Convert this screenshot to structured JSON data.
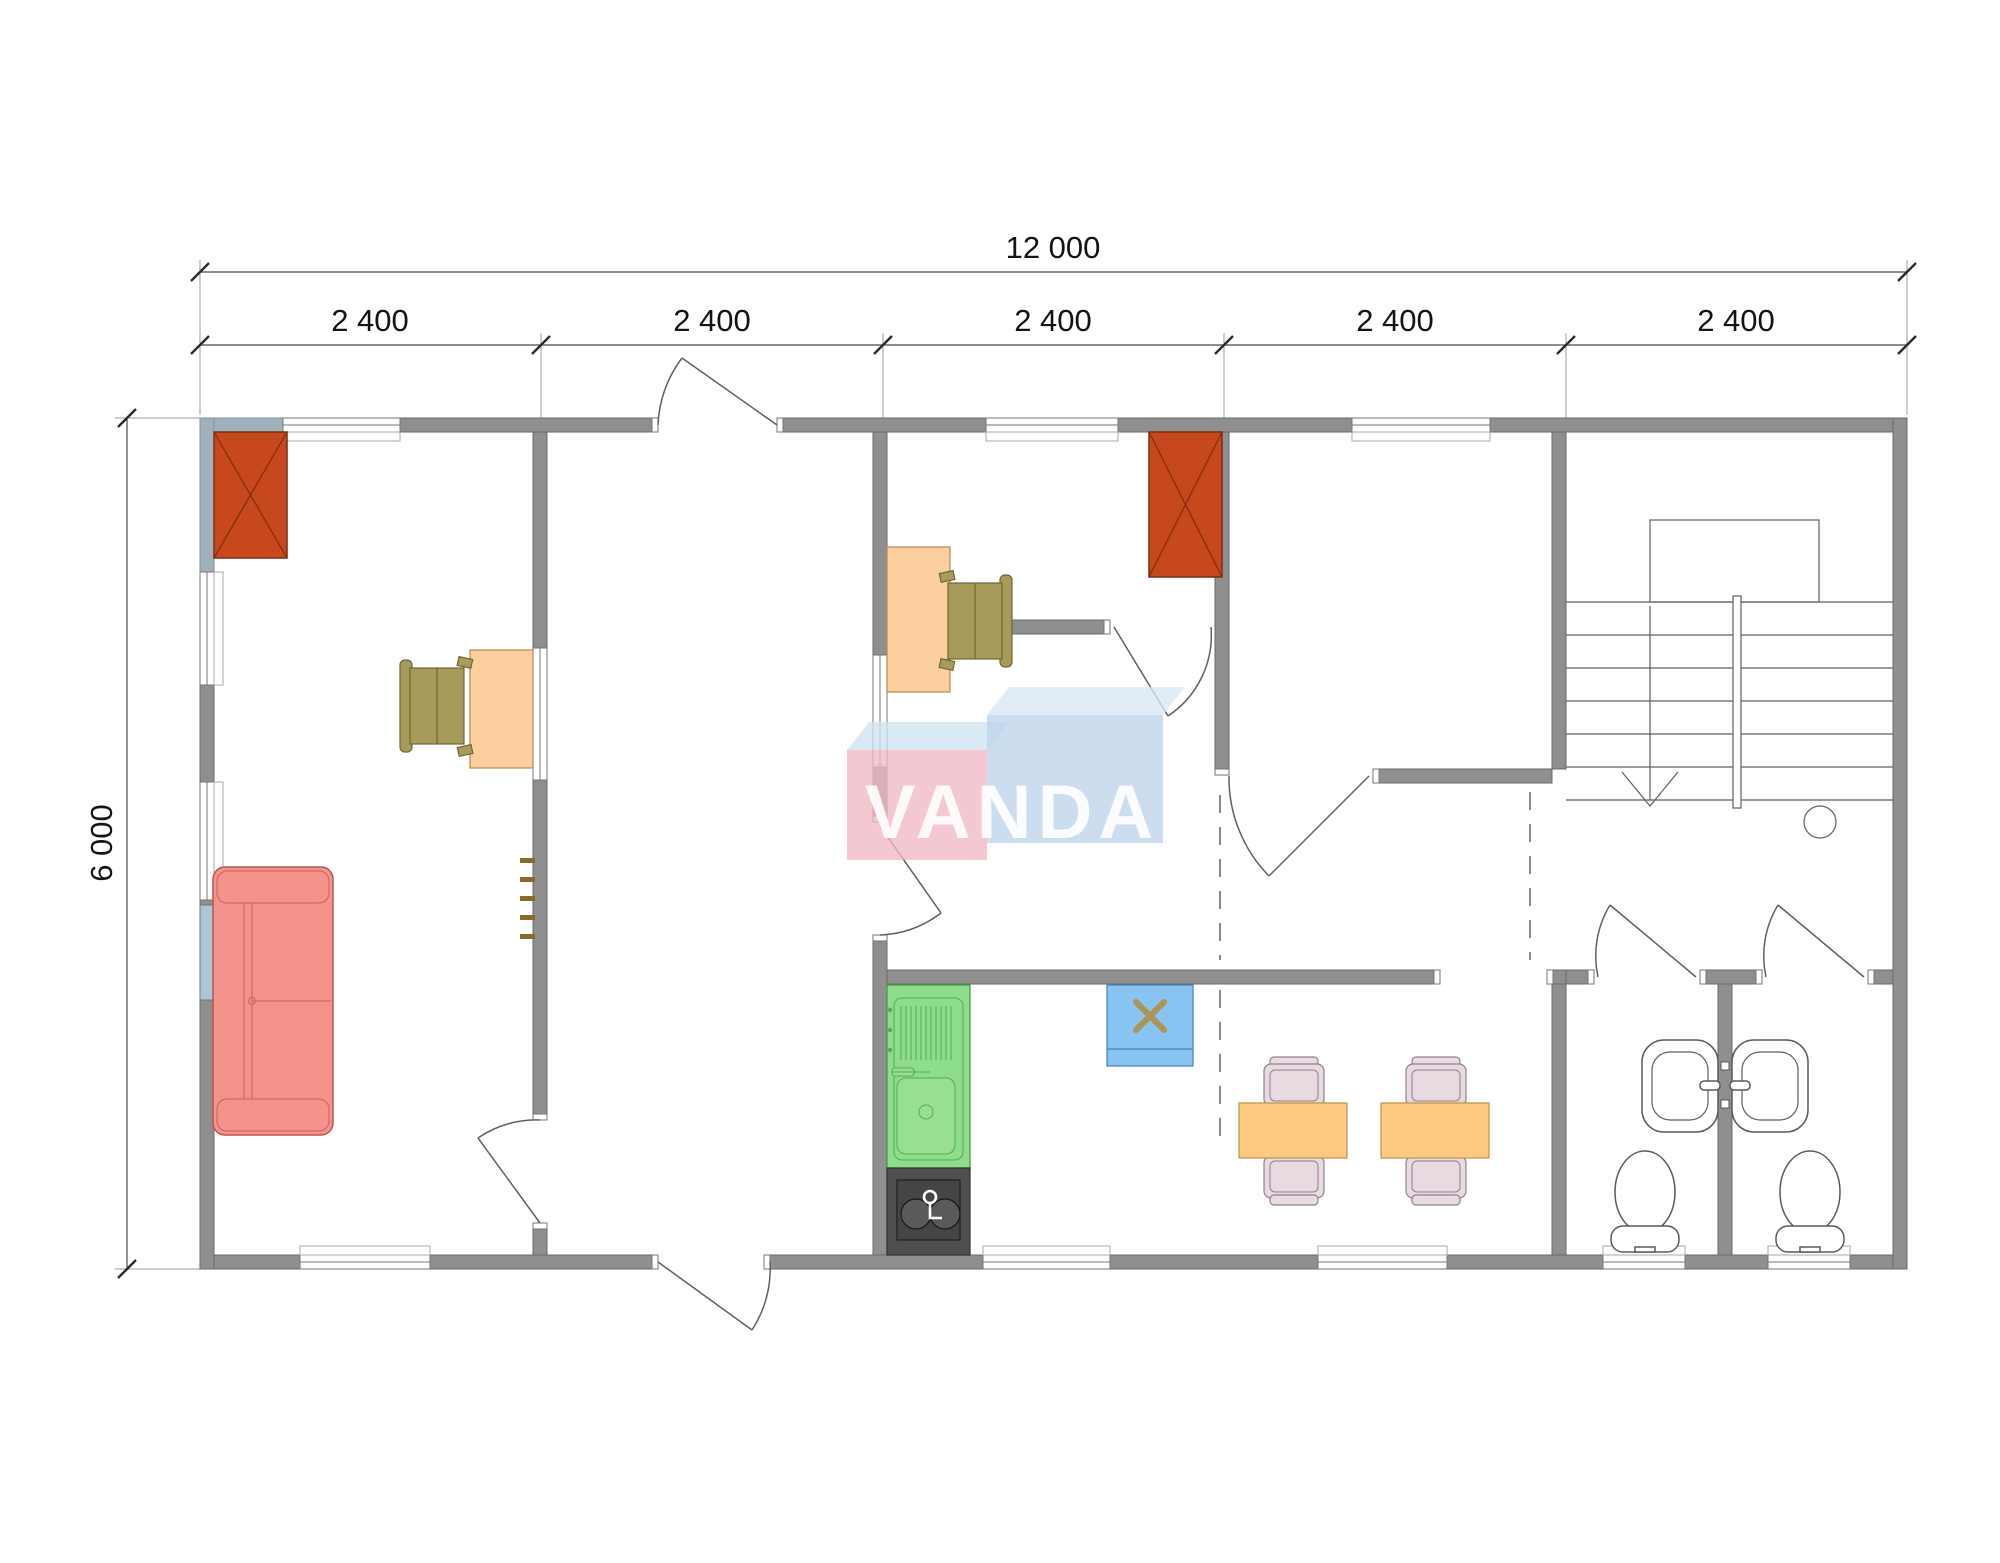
{
  "drawing": {
    "type": "architectural-floor-plan",
    "dimensions": {
      "total_width": "12 000",
      "segments": [
        "2 400",
        "2 400",
        "2 400",
        "2 400",
        "2 400"
      ],
      "total_height": "6 000"
    },
    "watermark": {
      "text": "VANDA",
      "left_box_color": "#f0b9c4",
      "right_box_color": "#bdd3e9",
      "text_color": "#ffffff"
    },
    "colors": {
      "wall": "#8f8f8f",
      "wardrobe": "#c8481d",
      "desk": "#fcd09e",
      "office_chair": "#a79b5c",
      "sofa": "#f4928c",
      "dining_table": "#fbca80",
      "dining_chair": "#e7dae0",
      "kitchen_unit": "#8edd8d",
      "stove": "#4f4f4f",
      "appliance": "#88c4f2",
      "glazing": "#a9c6d4"
    },
    "elements": [
      "wardrobe-left-office",
      "wardrobe-middle-office",
      "desk-left-office",
      "desk-middle-office",
      "sofa",
      "coat-hooks",
      "kitchen-sink-unit",
      "stove",
      "water-heater",
      "dining-table-1",
      "dining-table-2",
      "washbasins",
      "toilet-1",
      "toilet-2",
      "staircase"
    ]
  }
}
